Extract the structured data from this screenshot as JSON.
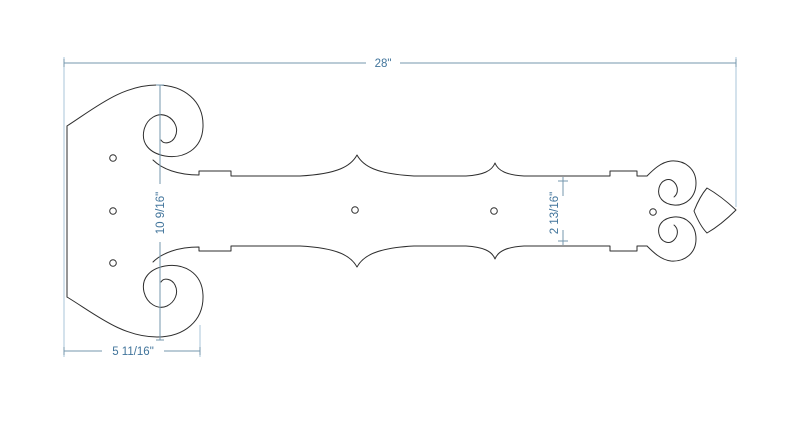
{
  "dimensions": {
    "overall_length": {
      "label": "28\""
    },
    "plate_height": {
      "label": "10 9/16\""
    },
    "strap_width": {
      "label": "2 13/16\""
    },
    "plate_width": {
      "label": "5 11/16\""
    }
  },
  "holes": {
    "radius": 3.3,
    "positions": [
      {
        "x": 113,
        "y": 158
      },
      {
        "x": 113,
        "y": 211
      },
      {
        "x": 113,
        "y": 263
      },
      {
        "x": 355,
        "y": 210
      },
      {
        "x": 494,
        "y": 211
      },
      {
        "x": 653,
        "y": 212
      }
    ]
  },
  "colors": {
    "background": "#ffffff",
    "outline": "#2e2e2e",
    "dimension_line": "#7497ad",
    "extension_line": "#a9c6d8",
    "dimension_text": "#41749b"
  }
}
